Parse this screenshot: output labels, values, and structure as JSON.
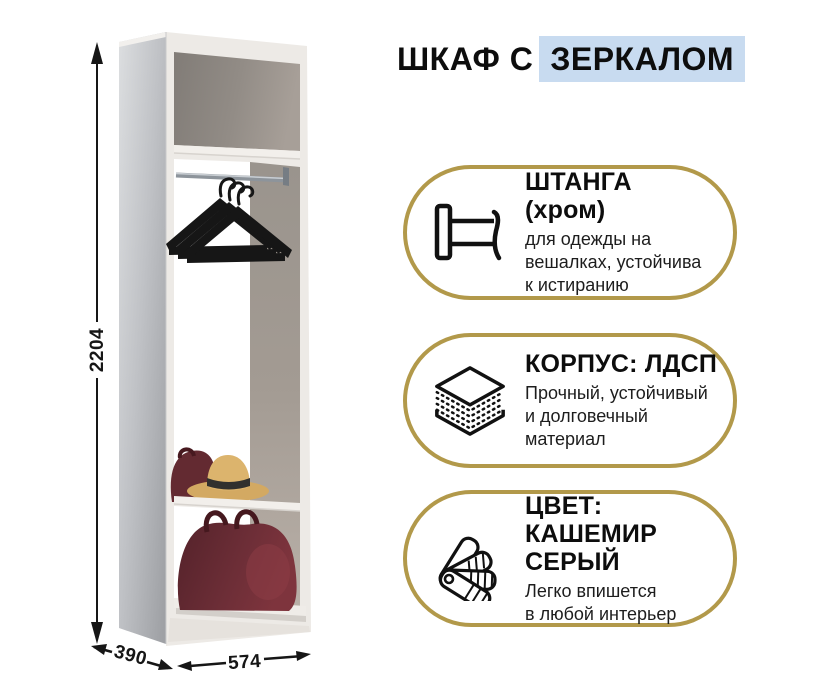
{
  "title": {
    "prefix": "ШКАФ С",
    "highlight": "ЗЕРКАЛОМ"
  },
  "dimensions": {
    "height_mm": "2204",
    "depth_mm": "390",
    "width_mm": "574"
  },
  "features": [
    {
      "icon": "clothes-rail-icon",
      "title": "ШТАНГА (хром)",
      "description": "для одежды на\nвешалках, устойчива\nк истиранию"
    },
    {
      "icon": "chipboard-layers-icon",
      "title": "КОРПУС: ЛДСП",
      "description": "Прочный, устойчивый\nи долговечный\nматериал"
    },
    {
      "icon": "color-fan-icon",
      "title": "ЦВЕТ:\nКАШЕМИР СЕРЫЙ",
      "description": "Легко впишется\nв любой интерьер"
    }
  ],
  "colors": {
    "accent_gold": "#b2994a",
    "title_highlight_blue": "#c8dbf0",
    "text": "#141414",
    "cabinet_body": "#edeae6",
    "cabinet_interior": "#8f8a84",
    "mirror_silver": "#b9bbbf",
    "bag_burgundy": "#632a31",
    "hat_straw": "#d3a962"
  },
  "wardrobe_contents": [
    "mirror side panel",
    "chrome rod",
    "three black hangers",
    "straw hat",
    "small burgundy bag",
    "large burgundy bag"
  ]
}
